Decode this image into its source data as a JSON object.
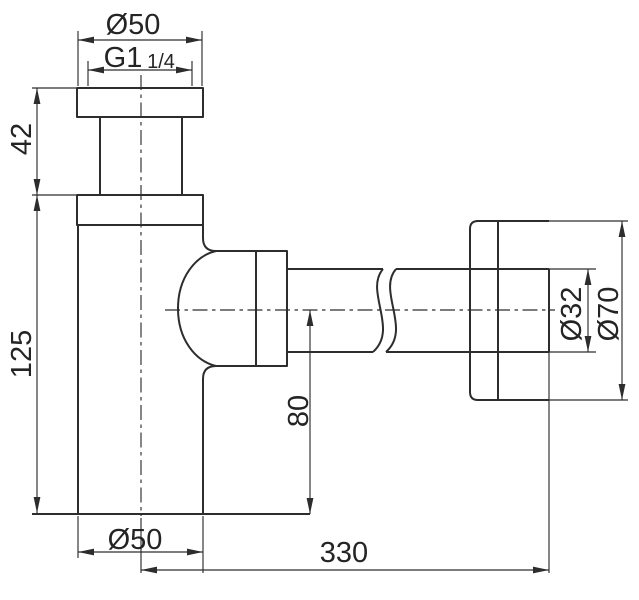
{
  "diagram": {
    "labels": {
      "top_diameter": "Ø50",
      "thread": "G1",
      "thread_fraction": "1/4",
      "inlet_height": "42",
      "body_height": "125",
      "outlet_center_height": "80",
      "body_diameter": "Ø50",
      "pipe_length": "330",
      "pipe_diameter": "Ø32",
      "wall_flange_diameter": "Ø70"
    }
  }
}
